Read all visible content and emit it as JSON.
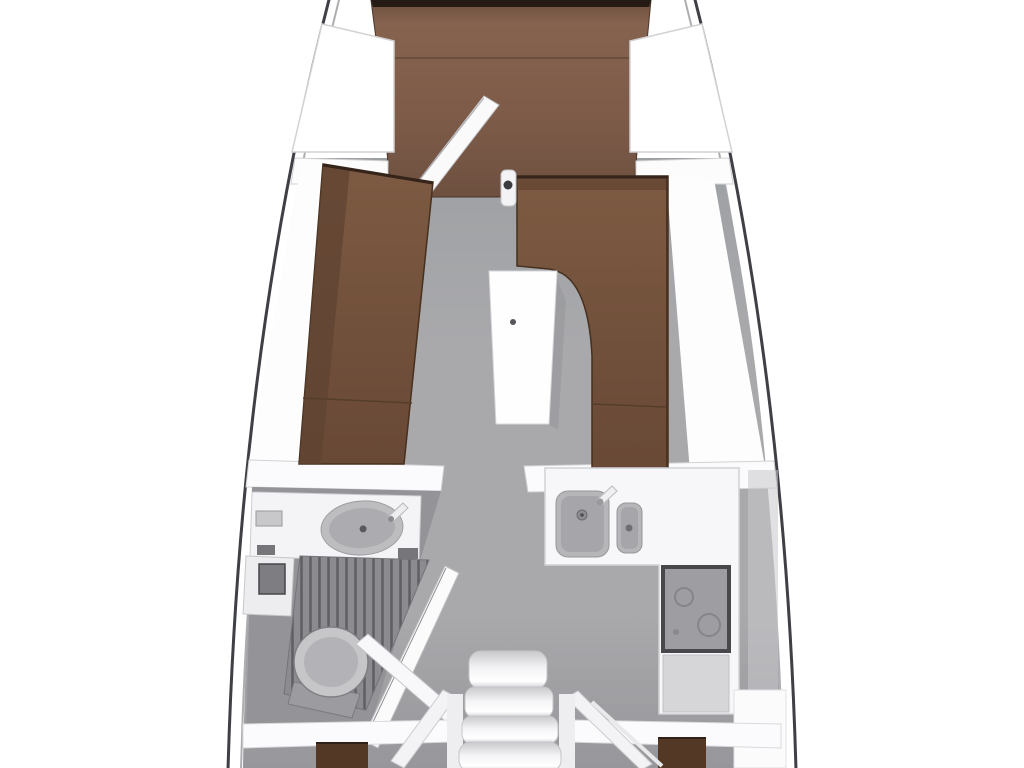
{
  "diagram": {
    "type": "sailboat-interior-floor-plan",
    "view": "top-down",
    "parts": [
      "hull",
      "v-berth",
      "bow-shelf-port",
      "bow-shelf-starboard",
      "forward-bulkhead",
      "forward-cabin-door",
      "forward-wardrobe",
      "port-settee",
      "starboard-l-settee",
      "saloon-table",
      "mast-post",
      "mid-bulkhead",
      "head-compartment",
      "head-vanity",
      "head-sink",
      "head-faucet",
      "shower-grate",
      "toilet",
      "head-door",
      "aft-port-cabin-door",
      "galley-counter",
      "galley-sink-large",
      "galley-sink-small",
      "galley-faucet",
      "stove",
      "galley-lower-panel",
      "companionway-steps",
      "stair-railings",
      "aft-bulkhead",
      "aft-port-berth",
      "aft-starboard-berth"
    ]
  },
  "colors": {
    "hull_line": "#3f4045",
    "hull_inner": "#aeaeb2",
    "trim": "#d2d2d5",
    "floor_top": "#9da0a3",
    "floor_mid": "#a9a9ac",
    "floor_bottom": "#97979b",
    "head_floor": "#939398",
    "berth_top": "#6b4e3d",
    "berth_mid": "#86634f",
    "berth_bottom": "#6e5040",
    "settee_light": "#7d5a42",
    "settee_shade": "#684936",
    "settee_dark": "#5f4331",
    "settee_edge": "#35241a",
    "aft_berth": "#543826",
    "sink": "#b6b6b9",
    "sink_inner": "#a6a6aa",
    "stove": "#9e9ea2",
    "stove_border": "#48484c",
    "grate": "#8b8b90",
    "grate_slat": "#5e5e63",
    "step_light": "#f4f4f6",
    "step_shade": "#c9c9cd",
    "panel": "#d6d6d9",
    "fixture_white": "#f7f7f9",
    "table_white": "#fefeff",
    "toilet": "#c6c6c9"
  }
}
